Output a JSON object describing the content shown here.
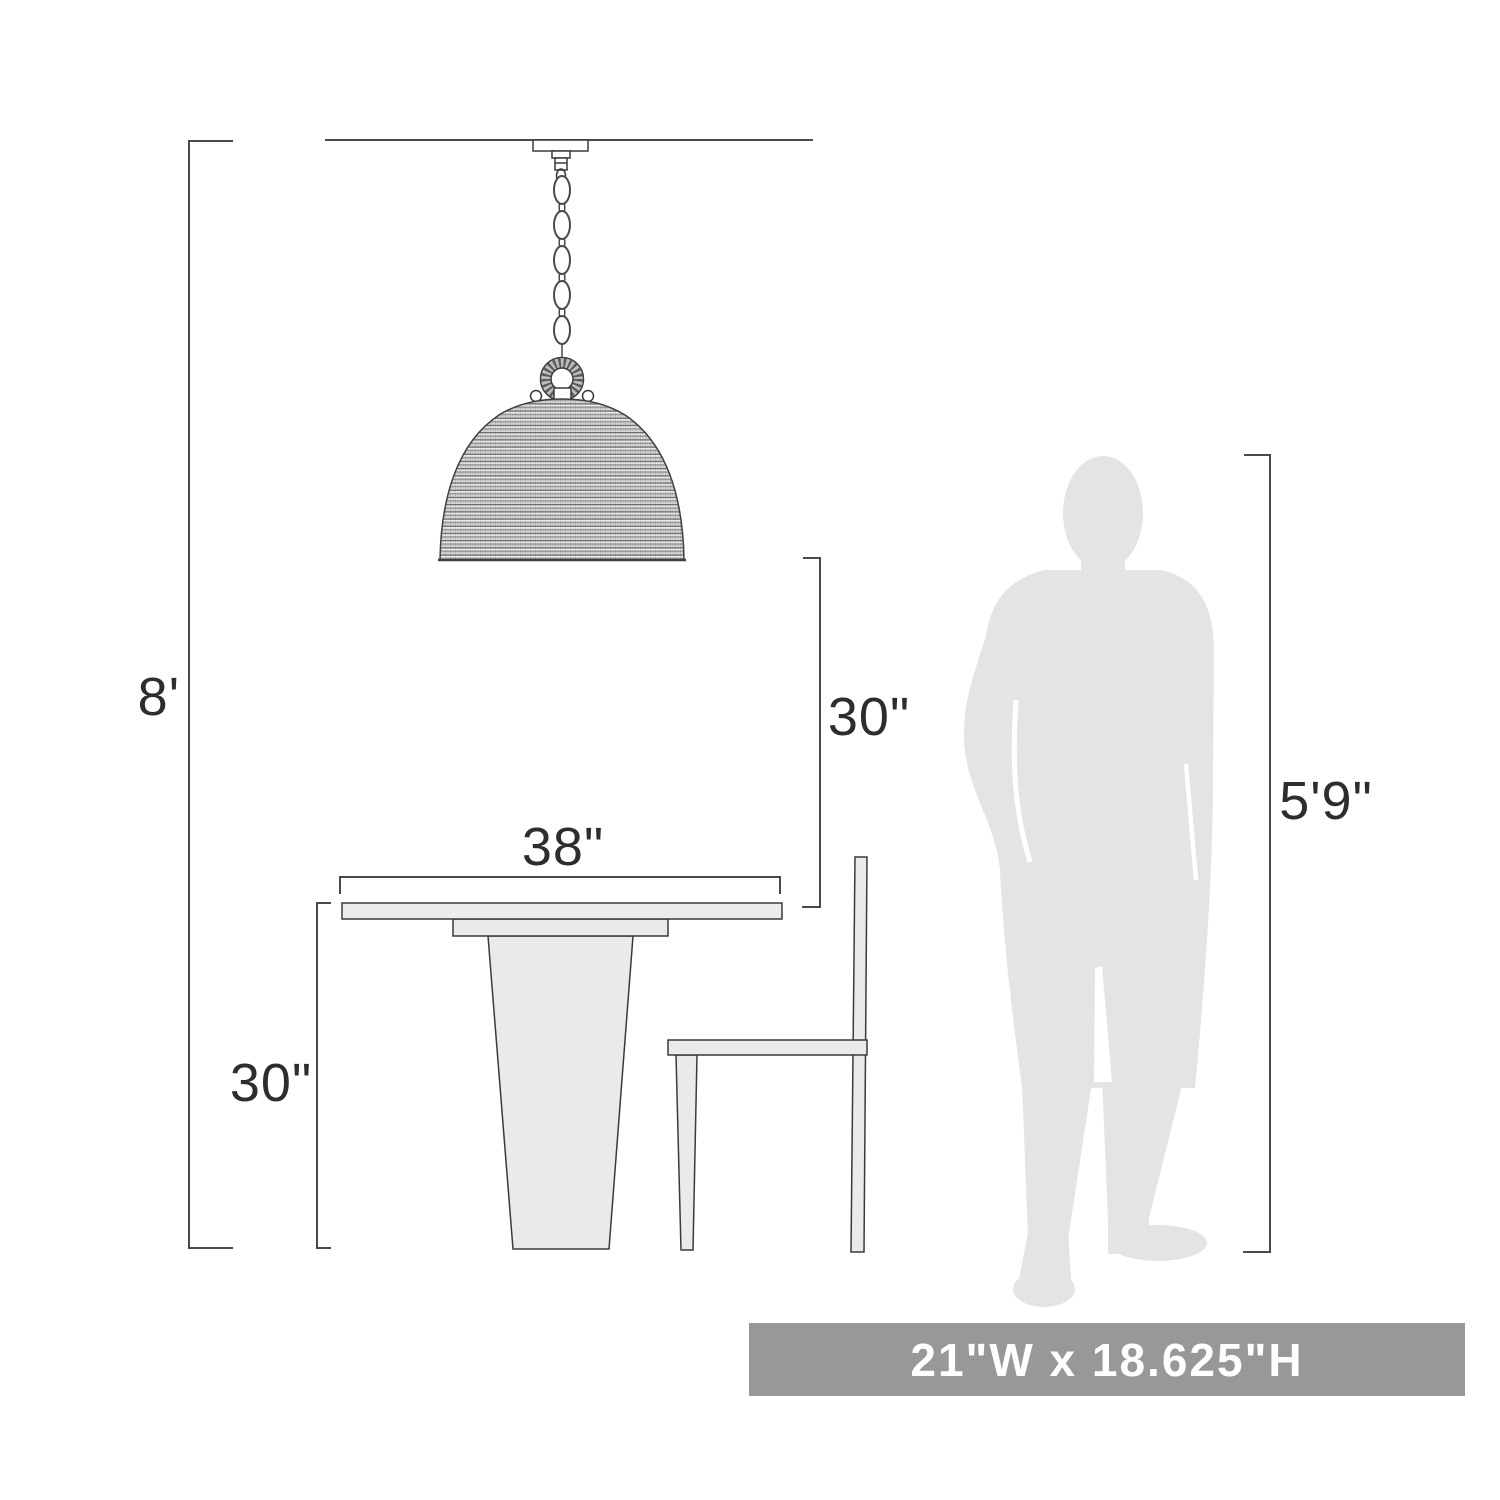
{
  "figure": {
    "type": "product-dimension-diagram",
    "subject": "pendant light over dining table with chair and human silhouette"
  },
  "dimensions": {
    "ceiling_height": "8'",
    "pendant_to_table": "30\"",
    "table_width": "38\"",
    "table_height": "30\"",
    "person_height": "5'9\""
  },
  "banner": {
    "text": "21\"W x 18.625\"H",
    "bg_color": "#989898",
    "text_color": "#ffffff"
  },
  "colors": {
    "background": "#ffffff",
    "dimension_line": "#4a4a4a",
    "outline": "#3a3a3a",
    "furniture_fill": "#eaeaea",
    "silhouette_fill": "#e3e4e6",
    "label_text": "#2d2d2d"
  }
}
